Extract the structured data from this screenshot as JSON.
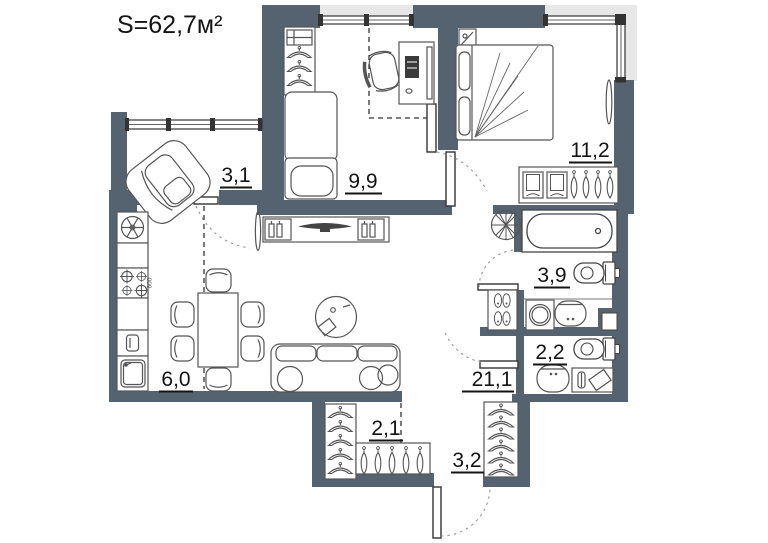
{
  "title": "S=62,7м²",
  "colors": {
    "wall": "#556371",
    "window_band": "#e7e7e7",
    "line": "#4a4a4a",
    "text": "#141414",
    "background": "#ffffff"
  },
  "rooms": [
    {
      "name": "loggia",
      "area": "3,1"
    },
    {
      "name": "bedroom",
      "area": "9,9"
    },
    {
      "name": "master-bedroom",
      "area": "11,2"
    },
    {
      "name": "bathroom",
      "area": "3,9"
    },
    {
      "name": "toilet",
      "area": "2,2"
    },
    {
      "name": "living-kitchen",
      "area": "21,1"
    },
    {
      "name": "kitchen-zone",
      "area": "6,0"
    },
    {
      "name": "wardrobe",
      "area": "2,1"
    },
    {
      "name": "hallway",
      "area": "3,2"
    }
  ],
  "annotations": {
    "stove_width_label": "600"
  },
  "furniture": [
    "armchair",
    "fridge",
    "stove",
    "oven",
    "kitchen-sink",
    "dining-table",
    "dining-chairs",
    "tv-stand",
    "tv",
    "mirror",
    "coffee-table",
    "sofa",
    "hanger-wardrobes",
    "single-bed",
    "desk",
    "office-chair",
    "double-bed",
    "nightstand",
    "dresser",
    "bathtub",
    "toilets",
    "washing-machine",
    "sinks",
    "shoe-cabinet",
    "plant",
    "entry-door"
  ]
}
